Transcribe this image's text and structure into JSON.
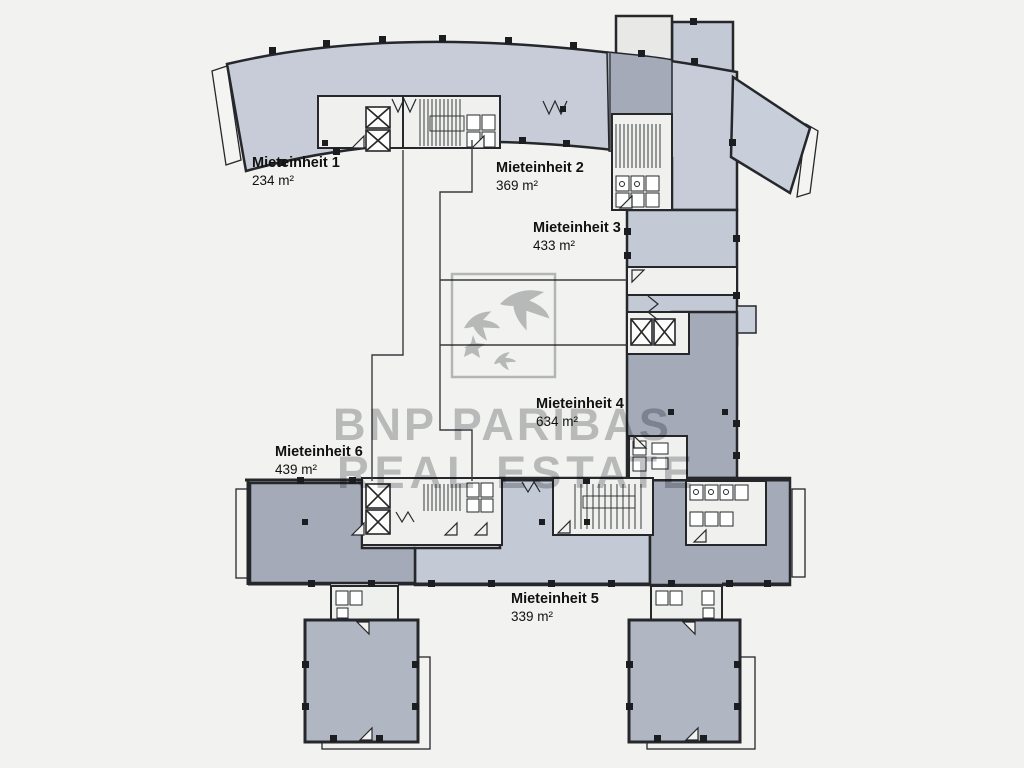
{
  "watermark": {
    "line1": "BNP PARIBAS",
    "line2": "REAL ESTATE"
  },
  "units": [
    {
      "name": "Mieteinheit 1",
      "area": "234 m²"
    },
    {
      "name": "Mieteinheit 2",
      "area": "369 m²"
    },
    {
      "name": "Mieteinheit 3",
      "area": "433 m²"
    },
    {
      "name": "Mieteinheit 4",
      "area": "634 m²"
    },
    {
      "name": "Mieteinheit 5",
      "area": "339 m²"
    },
    {
      "name": "Mieteinheit 6",
      "area": "439 m²"
    }
  ],
  "colors": {
    "background": "#f2f3f0",
    "unit_light_fill": "#c7ccd8",
    "unit_dark_fill": "#a4aab8",
    "tower_fill": "#b0b6c2",
    "wall": "#26272b",
    "watermark_gray": "#8f9196"
  }
}
